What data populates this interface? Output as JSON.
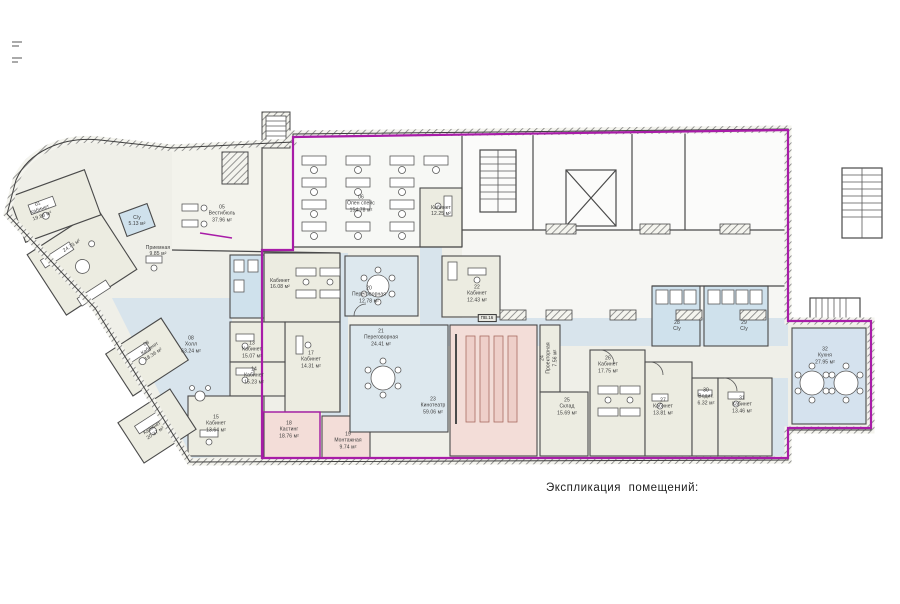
{
  "caption": "Экспликация  помещений:",
  "colors": {
    "boundary": "#a81ca8",
    "wall": "#4a4a4a",
    "corridor_fill": "#d8e4ec",
    "wet_fill": "#cfe1ec",
    "meeting_fill": "#dde8ee",
    "office_fill": "#ecece1",
    "cinema_fill": "#f3ddd8",
    "cinema_seat": "#eecfc9",
    "openspace_fill": "#f7f8f5",
    "base_fill": "#efefe8",
    "text": "#3a3a3a"
  },
  "tags": [
    {
      "text": "ПВ.16",
      "x": 487,
      "y": 318
    }
  ],
  "rooms": [
    {
      "num": "01",
      "name": "Кабинет",
      "area": "19.86 м²",
      "x": 40,
      "y": 210,
      "rot": -20
    },
    {
      "num": "",
      "name": "",
      "area": "24.73 м²",
      "x": 72,
      "y": 246,
      "rot": -33
    },
    {
      "num": "",
      "name": "С/у",
      "area": "5.13 м²",
      "x": 137,
      "y": 221,
      "rot": 0
    },
    {
      "num": "05",
      "name": "Вестибюль",
      "area": "37.96 м²",
      "x": 222,
      "y": 214,
      "rot": 0
    },
    {
      "num": "",
      "name": "Приемная",
      "area": "9.85 м²",
      "x": 158,
      "y": 251,
      "rot": 0
    },
    {
      "num": "06",
      "name": "Опен спейс",
      "area": "154.78 м²",
      "x": 361,
      "y": 204,
      "rot": 0
    },
    {
      "num": "",
      "name": "Кабинет",
      "area": "12.25 м²",
      "x": 441,
      "y": 211,
      "rot": 0
    },
    {
      "num": "08",
      "name": "Холл",
      "area": "63.24 м²",
      "x": 191,
      "y": 345,
      "rot": 0
    },
    {
      "num": "09",
      "name": "Кабинет",
      "area": "18.36 м²",
      "x": 150,
      "y": 349,
      "rot": -33
    },
    {
      "num": "",
      "name": "Кабинет",
      "area": "20.37 м²",
      "x": 154,
      "y": 431,
      "rot": -33
    },
    {
      "num": "13",
      "name": "Кабинет",
      "area": "15.07 м²",
      "x": 252,
      "y": 350,
      "rot": 0
    },
    {
      "num": "14",
      "name": "Кабинет",
      "area": "15.23 м²",
      "x": 254,
      "y": 376,
      "rot": 0
    },
    {
      "num": "15",
      "name": "Кабинет",
      "area": "13.64 м²",
      "x": 216,
      "y": 424,
      "rot": 0
    },
    {
      "num": "",
      "name": "Кабинет",
      "area": "16.08 м²",
      "x": 280,
      "y": 284,
      "rot": 0
    },
    {
      "num": "17",
      "name": "Кабинет",
      "area": "14.31 м²",
      "x": 311,
      "y": 360,
      "rot": 0
    },
    {
      "num": "18",
      "name": "Кастинг",
      "area": "18.76 м²",
      "x": 289,
      "y": 430,
      "rot": 0
    },
    {
      "num": "19",
      "name": "Монтажная",
      "area": "9.74 м²",
      "x": 348,
      "y": 441,
      "rot": 0
    },
    {
      "num": "20",
      "name": "Переговорная",
      "area": "12.78 м²",
      "x": 369,
      "y": 295,
      "rot": 0
    },
    {
      "num": "21",
      "name": "Переговорная",
      "area": "24.41 м²",
      "x": 381,
      "y": 338,
      "rot": 0
    },
    {
      "num": "22",
      "name": "Кабинет",
      "area": "12.43 м²",
      "x": 477,
      "y": 294,
      "rot": 0
    },
    {
      "num": "23",
      "name": "Кинотеатр",
      "area": "59.06 м²",
      "x": 433,
      "y": 406,
      "rot": 0
    },
    {
      "num": "24",
      "name": "Проекторная",
      "area": "7.56 м²",
      "x": 549,
      "y": 358,
      "rot": -90
    },
    {
      "num": "25",
      "name": "Склад",
      "area": "15.69 м²",
      "x": 567,
      "y": 407,
      "rot": 0
    },
    {
      "num": "26",
      "name": "Кабинет",
      "area": "17.75 м²",
      "x": 608,
      "y": 365,
      "rot": 0
    },
    {
      "num": "27",
      "name": "Кабинет",
      "area": "13.81 м²",
      "x": 663,
      "y": 407,
      "rot": 0
    },
    {
      "num": "28",
      "name": "С/у",
      "area": "",
      "x": 677,
      "y": 326,
      "rot": 0
    },
    {
      "num": "29",
      "name": "С/у",
      "area": "",
      "x": 744,
      "y": 326,
      "rot": 0
    },
    {
      "num": "30",
      "name": "Водит.",
      "area": "6.32 м²",
      "x": 706,
      "y": 397,
      "rot": 0
    },
    {
      "num": "31",
      "name": "Кабинет",
      "area": "13.46 м²",
      "x": 742,
      "y": 405,
      "rot": 0
    },
    {
      "num": "32",
      "name": "Кухня",
      "area": "27.95 м²",
      "x": 825,
      "y": 356,
      "rot": 0
    }
  ]
}
